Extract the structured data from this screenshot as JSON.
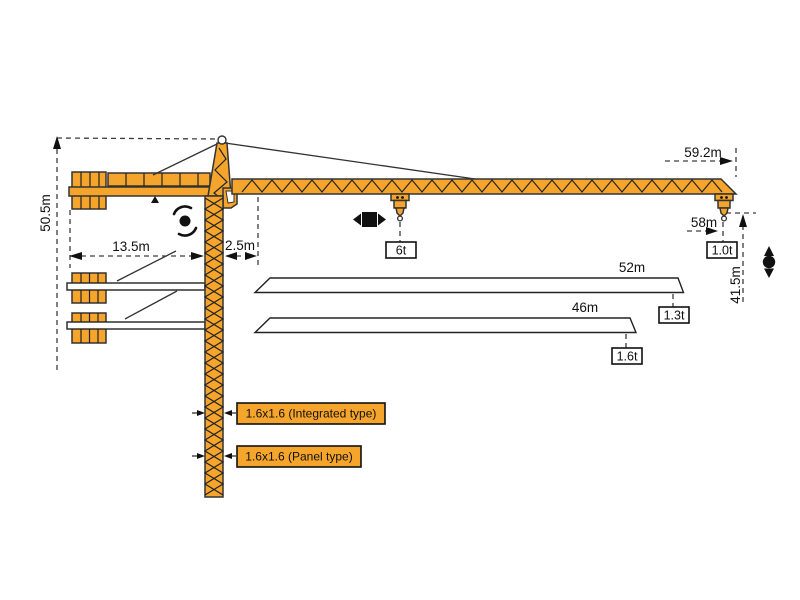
{
  "diagram": {
    "kind": "tower-crane-dimension-diagram",
    "dimensions": {
      "overall_height": "50.5m",
      "counterjib_radius": "13.5m",
      "root_offset": "2.5m",
      "max_jib_radius": "59.2m",
      "tip_hook_radius": "58m",
      "hook_height": "41.5m"
    },
    "loads": {
      "max_load": "6t",
      "tip_load_main": "1.0t"
    },
    "jib_options": [
      {
        "length": "52m",
        "tip_load": "1.3t"
      },
      {
        "length": "46m",
        "tip_load": "1.6t"
      }
    ],
    "mast_sections": [
      {
        "size_label": "1.6x1.6 (Integrated type)"
      },
      {
        "size_label": "1.6x1.6 (Panel type)"
      }
    ],
    "colors": {
      "crane_orange": "#F5A42C",
      "outline": "#333333",
      "dimension_line": "#3d3d3d",
      "background": "#ffffff"
    }
  }
}
